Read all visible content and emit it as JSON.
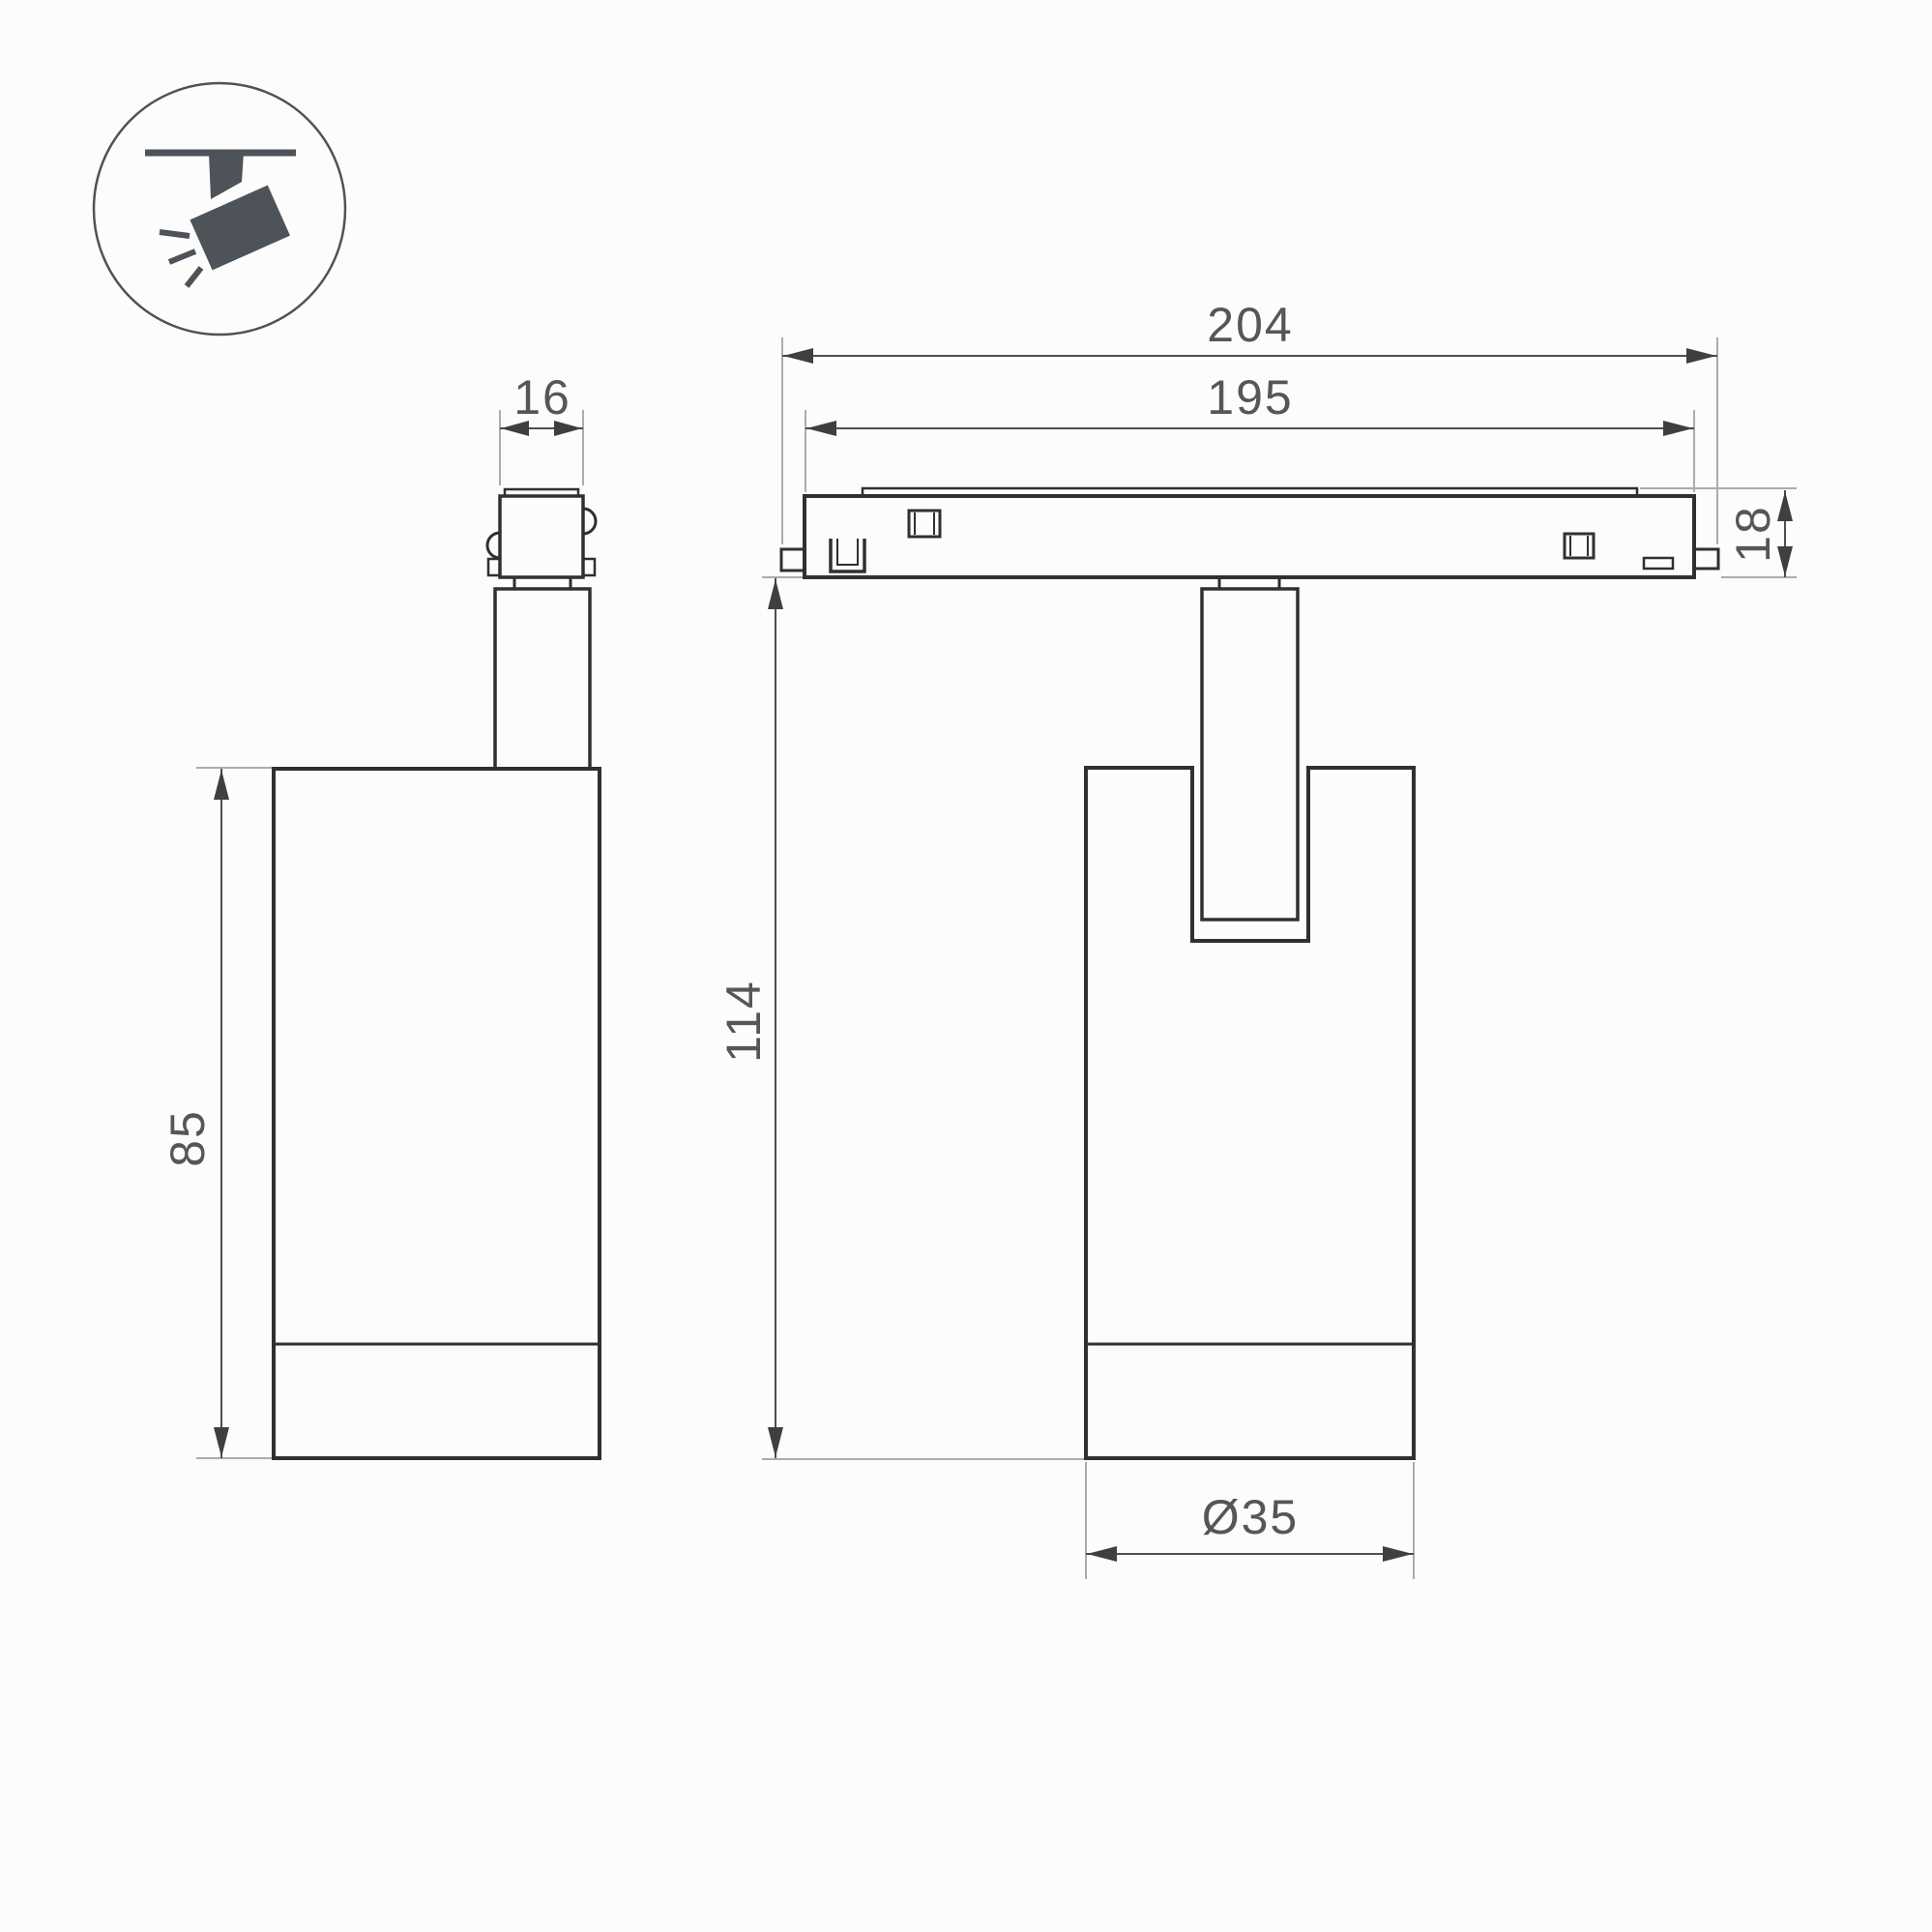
{
  "drawing": {
    "type": "technical-dimension-drawing",
    "subject": "magnetic track spotlight, side and front views with legend icon",
    "background": "#fcfcfc",
    "colors": {
      "outline": "#2e3032",
      "dimension_line": "#4d4f52",
      "extension_line": "#aaacae",
      "label_text": "#54575a",
      "icon": "#4d5358"
    },
    "icon": "track-spotlight-icon"
  },
  "dimensions": {
    "stem_width": {
      "label": "16"
    },
    "track_outer_length": {
      "label": "204"
    },
    "track_inner_length": {
      "label": "195"
    },
    "track_height": {
      "label": "18"
    },
    "body_height": {
      "label": "85"
    },
    "total_height": {
      "label": "114"
    },
    "body_diameter": {
      "label": "Ø35"
    }
  }
}
